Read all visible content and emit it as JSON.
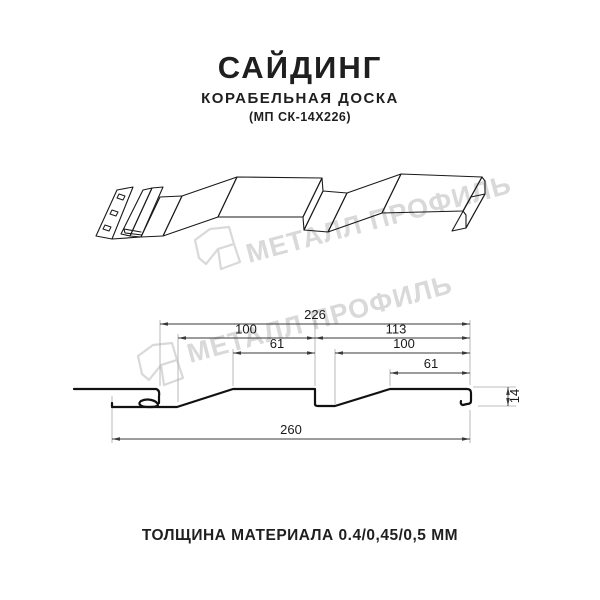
{
  "header": {
    "title": "САЙДИНГ",
    "subtitle": "КОРАБЕЛЬНАЯ ДОСКА",
    "model_code": "(МП СК-14Х226)"
  },
  "watermark": {
    "text": "МЕТАЛЛ ПРОФИЛЬ",
    "color": "#d9d9d9"
  },
  "cross_section": {
    "dims": {
      "total_top": "226",
      "left_board_100": "100",
      "right_board_113": "113",
      "left_plateau_61": "61",
      "right_board_100": "100",
      "right_plateau_61": "61",
      "height_14": "14",
      "overall_bottom_260": "260"
    }
  },
  "footer": {
    "text": "ТОЛЩИНА МАТЕРИАЛА 0.4/0,45/0,5 ММ"
  },
  "colors": {
    "background": "#ffffff",
    "line": "#1a1a1a",
    "dimension": "#3a3a3a",
    "extension": "#a8a8a8",
    "watermark": "#d9d9d9"
  }
}
